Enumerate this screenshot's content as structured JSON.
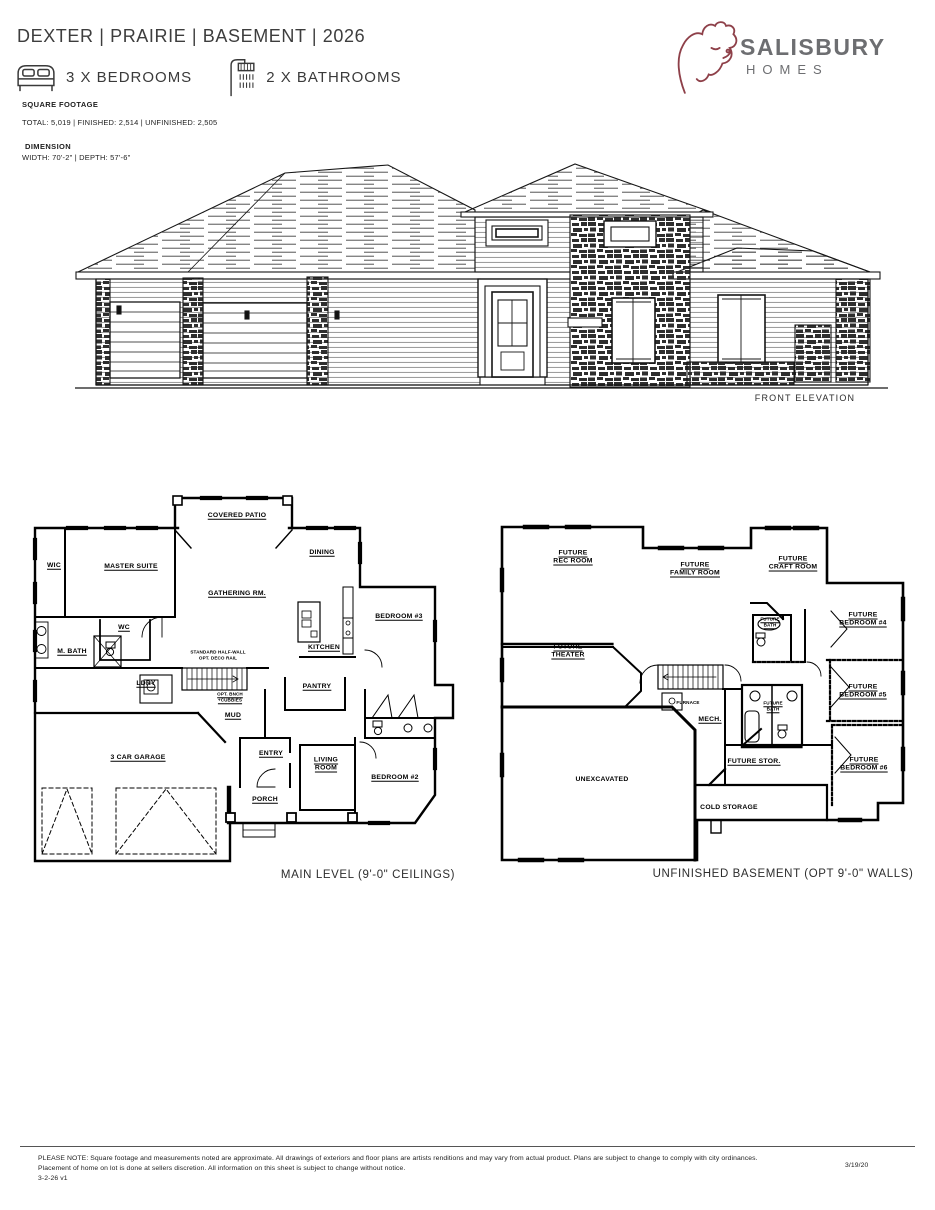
{
  "header": {
    "title": "DEXTER | PRAIRIE | BASEMENT | 2026",
    "bedrooms_label": "3 X BEDROOMS",
    "bathrooms_label": "2 X BATHROOMS",
    "sqft_heading": "SQUARE FOOTAGE",
    "sqft_detail": "TOTAL: 5,019 | FINISHED: 2,514 | UNFINISHED: 2,505",
    "dimension_heading": "DIMENSION",
    "dimension_detail": "WIDTH: 70'-2\" | DEPTH: 57'-6\""
  },
  "logo": {
    "name": "SALISBURY",
    "sub": "HOMES",
    "brand_color": "#8e4049",
    "text_color": "#6d6e71"
  },
  "elevation": {
    "caption": "FRONT ELEVATION"
  },
  "main_level": {
    "caption": "MAIN LEVEL (9'-0\" CEILINGS)",
    "rooms": {
      "covered_patio": "COVERED PATIO",
      "wic": "WIC",
      "master_suite": "MASTER SUITE",
      "dining": "DINING",
      "gathering": "GATHERING RM.",
      "bedroom3": "BEDROOM #3",
      "wc": "WC",
      "kitchen": "KITCHEN",
      "m_bath": "M. BATH",
      "ldry": "LDRY",
      "pantry": "PANTRY",
      "mud": "MUD",
      "garage": "3 CAR GARAGE",
      "entry": "ENTRY",
      "living": [
        "LIVING",
        "ROOM"
      ],
      "bedroom2": "BEDROOM #2",
      "porch": "PORCH"
    },
    "notes": {
      "stair": [
        "STANDARD HALF-WALL",
        "OPT. DECO RAIL"
      ],
      "bench": [
        "OPT. BNCH",
        "+CUBBIES"
      ]
    }
  },
  "basement": {
    "caption": "UNFINISHED BASEMENT (OPT 9'-0\" WALLS)",
    "rooms": {
      "rec": [
        "FUTURE",
        "REC ROOM"
      ],
      "family": [
        "FUTURE",
        "FAMILY ROOM"
      ],
      "craft": [
        "FUTURE",
        "CRAFT ROOM"
      ],
      "bath_upper": [
        "FUTURE",
        "BATH"
      ],
      "bedroom4": [
        "FUTURE",
        "BEDROOM #4"
      ],
      "theater": [
        "FUTURE",
        "THEATER"
      ],
      "bedroom5": [
        "FUTURE",
        "BEDROOM #5"
      ],
      "bath_lower": [
        "FUTURE",
        "BATH"
      ],
      "mech": "MECH.",
      "furnace": "FURNACE",
      "unexcavated": "UNEXCAVATED",
      "storage": "FUTURE STOR.",
      "cold_storage": "COLD STORAGE",
      "bedroom6": [
        "FUTURE",
        "BEDROOM #6"
      ]
    }
  },
  "footer": {
    "line1": "PLEASE NOTE: Square footage and measurements noted are approximate. All drawings of exteriors and floor plans are artists renditions and may vary from actual product. Plans are subject to change to comply with city ordinances.",
    "line2": "Placement of home on lot is done at sellers discretion. All information on this sheet is subject to change without notice.",
    "version": "3-2-26 v1",
    "date": "3/19/20"
  }
}
